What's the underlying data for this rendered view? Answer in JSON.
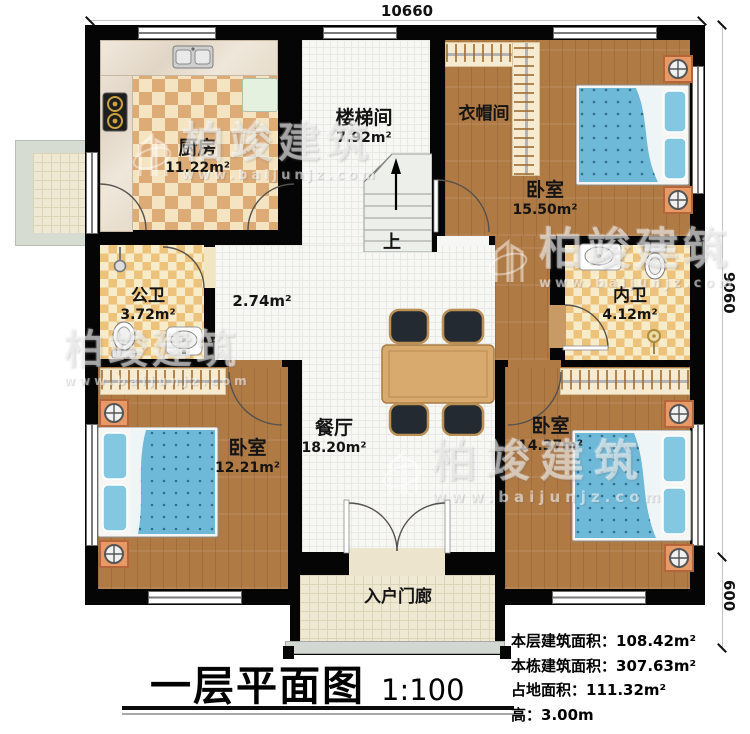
{
  "page": {
    "title": "一层平面图",
    "scale": "1:100"
  },
  "dimensions": {
    "top": "10660",
    "right_upper": "9060",
    "right_lower": "600"
  },
  "rooms": {
    "kitchen": {
      "name": "厨房",
      "area": "11.22m²"
    },
    "stairwell": {
      "name": "楼梯间",
      "area": "7.92m²"
    },
    "cloakroom": {
      "name": "衣帽间"
    },
    "bedroom_top_right": {
      "name": "卧室",
      "area": "15.50m²"
    },
    "public_bathroom": {
      "name": "公卫",
      "area": "3.72m²"
    },
    "hallway": {
      "area": "2.74m²"
    },
    "private_bathroom": {
      "name": "内卫",
      "area": "4.12m²"
    },
    "bedroom_bottom_left": {
      "name": "卧室",
      "area": "12.21m²"
    },
    "dining_room": {
      "name": "餐厅",
      "area": "18.20m²"
    },
    "bedroom_bottom_right": {
      "name": "卧室",
      "area": "14.37m²"
    },
    "entrance_porch": {
      "name": "入户门廊"
    }
  },
  "stairs": {
    "up_label": "上"
  },
  "stats": {
    "floor_area_label": "本层建筑面积：",
    "floor_area_value": "108.42m²",
    "building_area_label": "本栋建筑面积：",
    "building_area_value": "307.63m²",
    "footprint_label": "占地面积：",
    "footprint_value": "111.32m²",
    "height_label": "高：",
    "height_value": "3.00m"
  },
  "watermark": {
    "brand": "柏竣建筑",
    "url": "www.baijunjz.com"
  },
  "colors": {
    "wall": "#050505",
    "wood_floor": "#b07a45",
    "kitchen_tile_dark": "#dcab76",
    "kitchen_tile_light": "#f4e4c2",
    "bath_tile_dark": "#edc27b",
    "bed_blue": "#6fb9d8",
    "table_wood": "#d9aa6e",
    "chair_dark": "#232a32",
    "nightstand_orange": "#e89a66"
  }
}
